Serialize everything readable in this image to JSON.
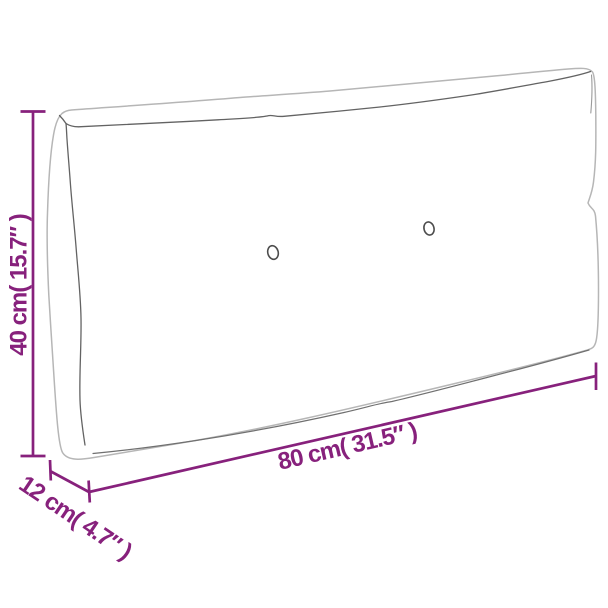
{
  "image": {
    "title": "Pallet cushion dimension diagram",
    "background_color": "#ffffff"
  },
  "colors": {
    "accent": "#87217c",
    "outline": "#b6b6b6",
    "seam": "#636363",
    "bottom_seam": "#707070",
    "button_stroke": "#4d4d4d"
  },
  "dimensions": {
    "height": {
      "label": "40 cm( 15.7″ )",
      "cm": 40,
      "inches": 15.7
    },
    "width": {
      "label": "80 cm( 31.5″ )",
      "cm": 80,
      "inches": 31.5
    },
    "depth": {
      "label": "12 cm( 4.7″ )",
      "cm": 12,
      "inches": 4.7
    }
  }
}
